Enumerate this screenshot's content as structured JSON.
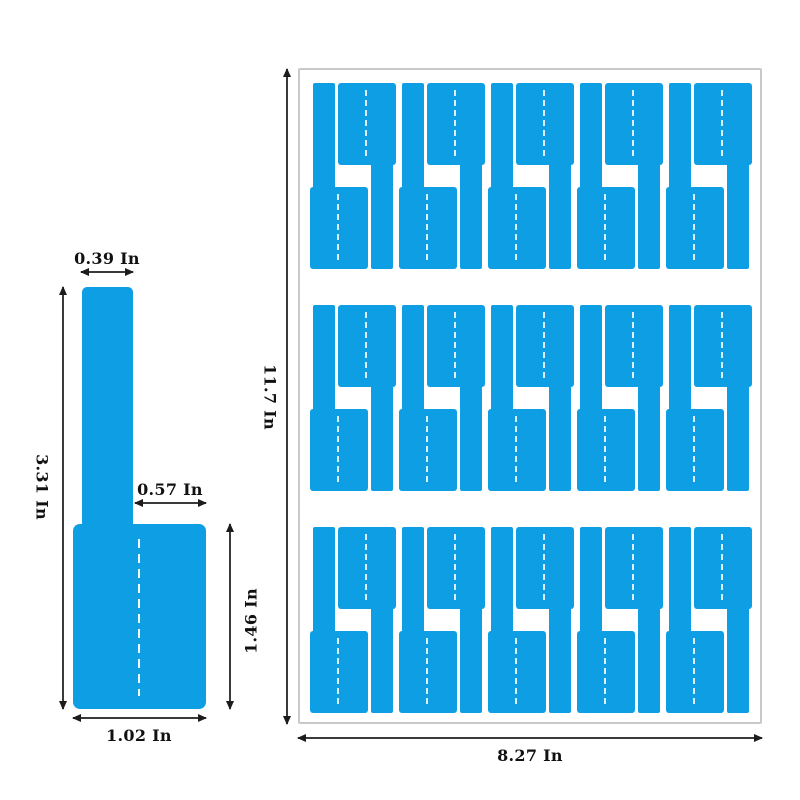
{
  "colors": {
    "label_blue": "#0d9ee3",
    "sheet_border": "#c9c9c9",
    "dimension_line": "#3a3a3a",
    "text": "#111111"
  },
  "single_label": {
    "strip_width": "0.39 In",
    "total_height": "3.31 In",
    "shoulder_width": "0.57 In",
    "flag_height": "1.46 In",
    "flag_width": "1.02 In"
  },
  "sheet": {
    "width": "8.27 In",
    "height": "11.7 In",
    "rows": 3,
    "pairs_per_row": 5
  }
}
